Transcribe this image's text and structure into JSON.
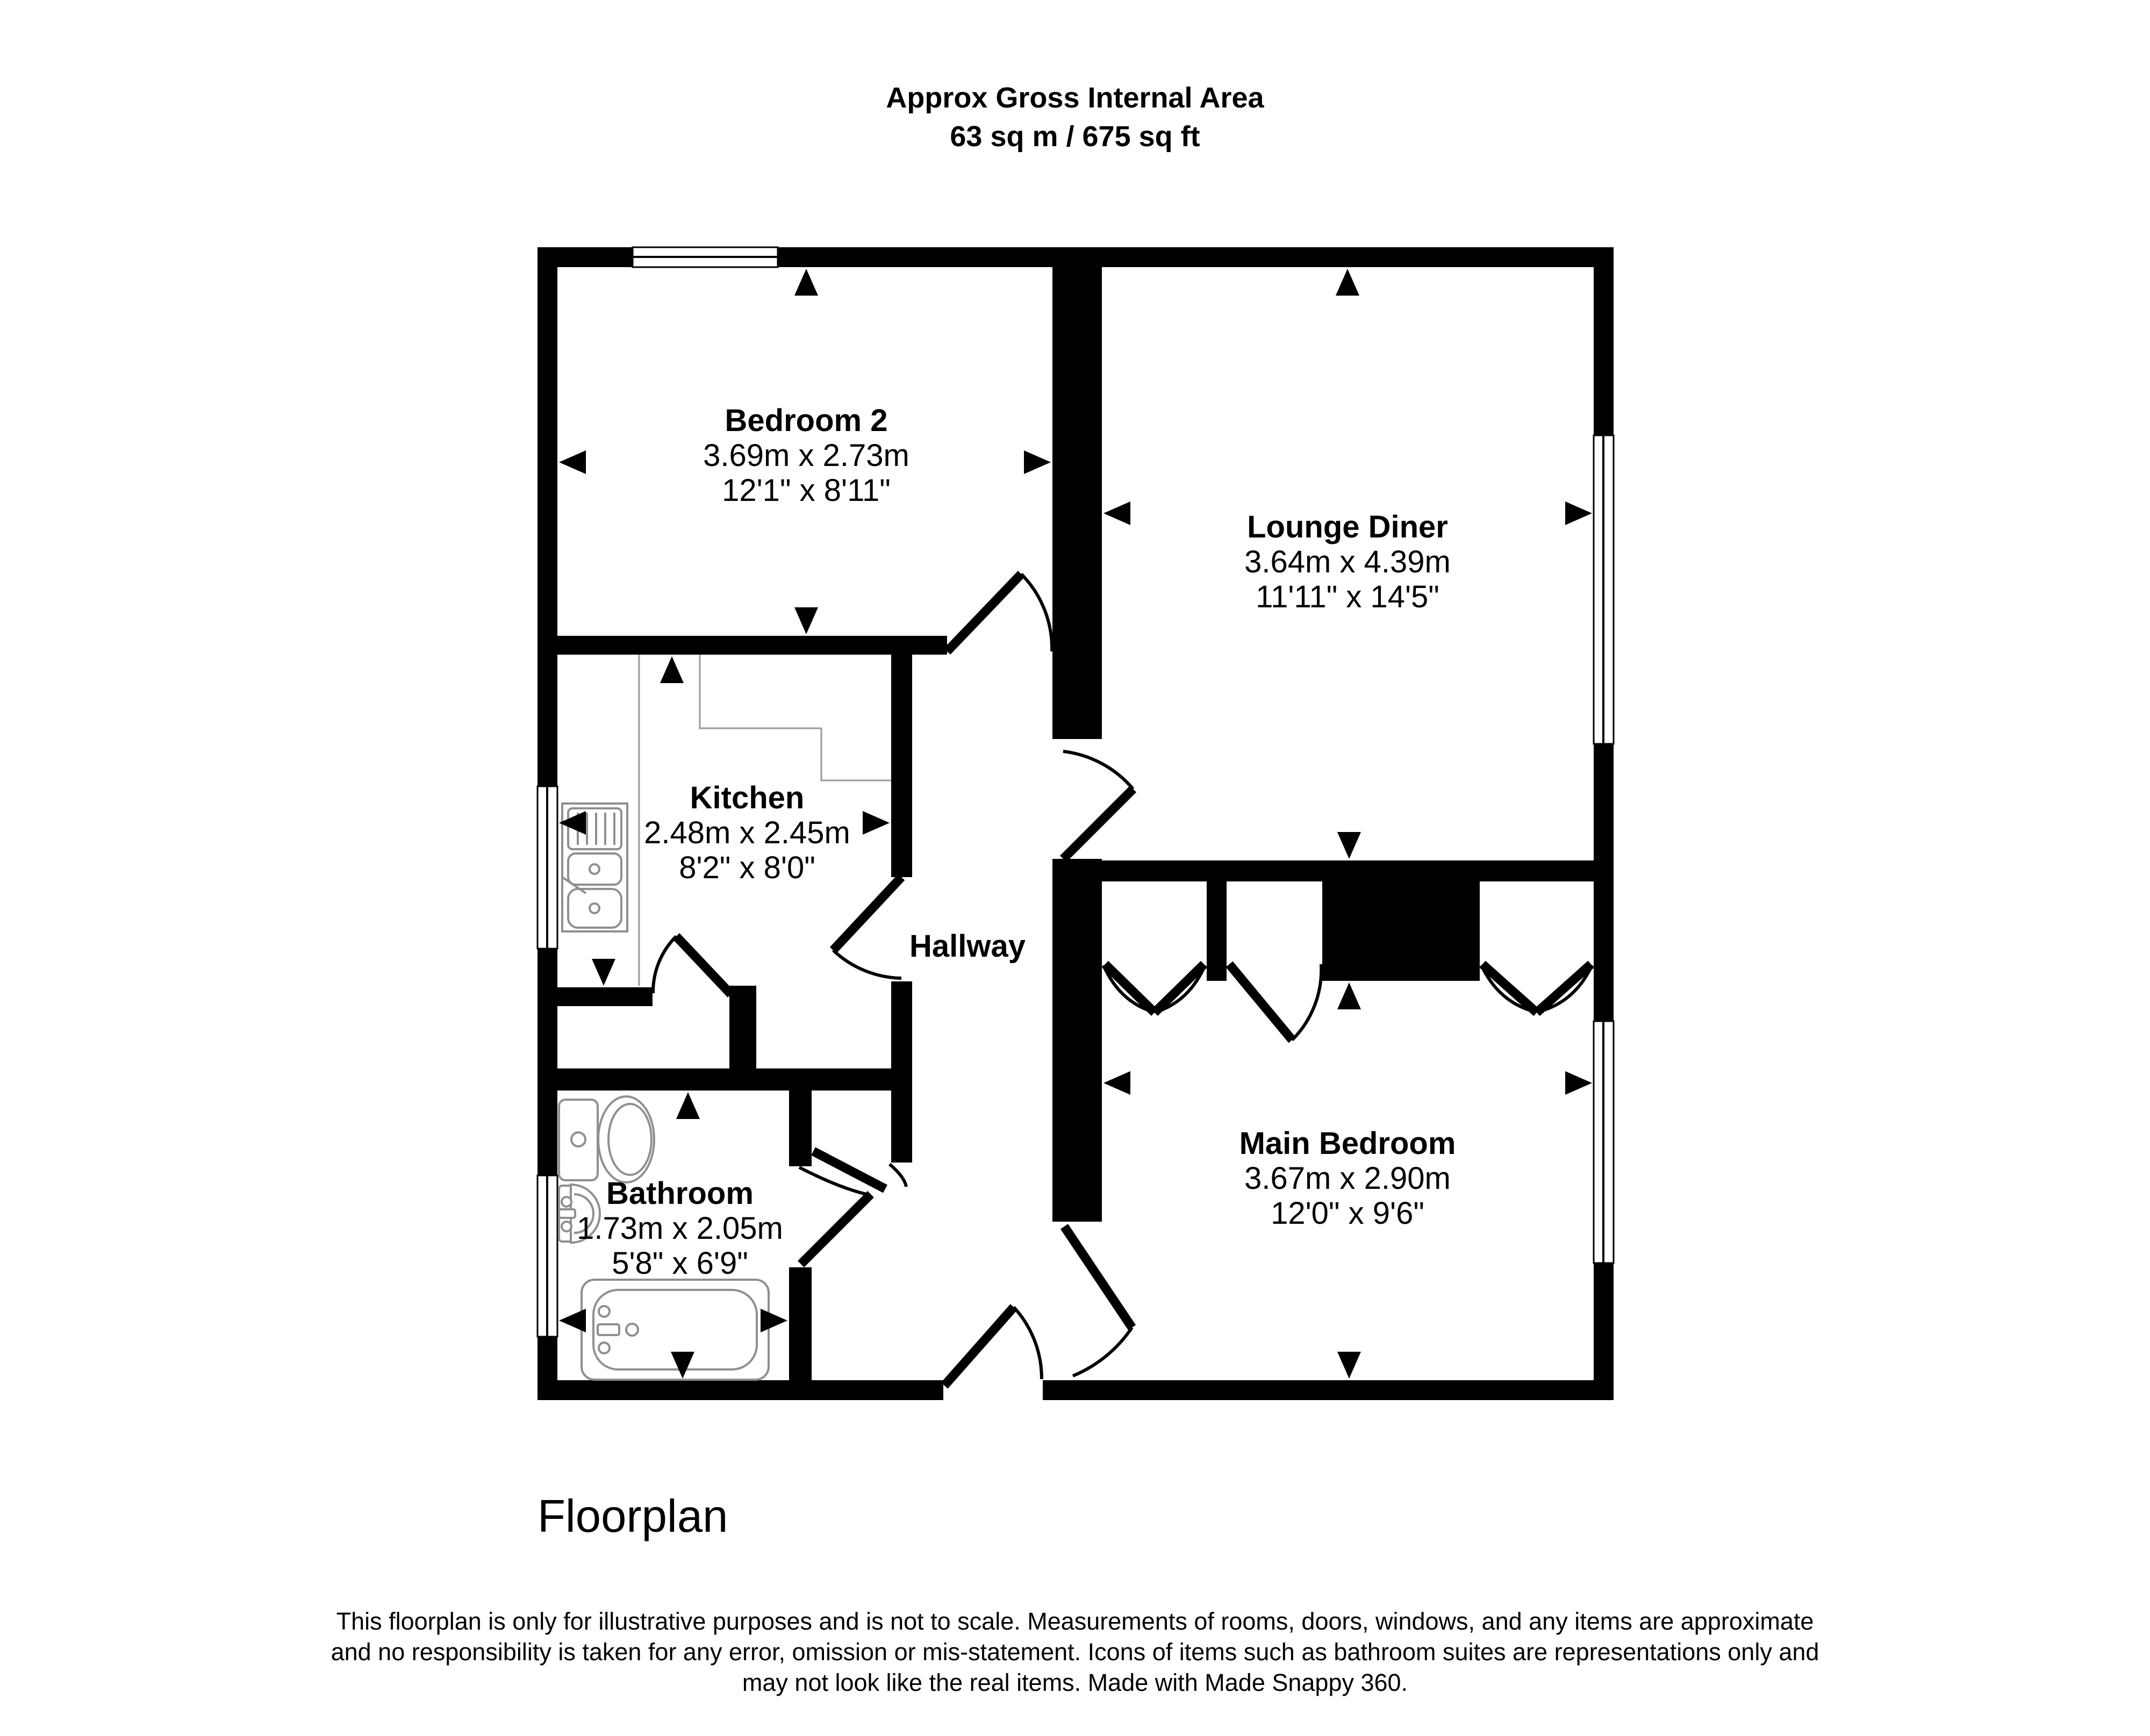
{
  "title": {
    "line1": "Approx Gross Internal Area",
    "line2": "63 sq m / 675 sq ft"
  },
  "rooms": [
    {
      "id": "bedroom-2",
      "name": "Bedroom 2",
      "metric": "3.69m x 2.73m",
      "imperial": "12'1\" x 8'11\""
    },
    {
      "id": "lounge-diner",
      "name": "Lounge Diner",
      "metric": "3.64m x 4.39m",
      "imperial": "11'11\" x 14'5\""
    },
    {
      "id": "kitchen",
      "name": "Kitchen",
      "metric": "2.48m x 2.45m",
      "imperial": "8'2\" x 8'0\""
    },
    {
      "id": "hallway",
      "name": "Hallway"
    },
    {
      "id": "bathroom",
      "name": "Bathroom",
      "metric": "1.73m x 2.05m",
      "imperial": "5'8\" x 6'9\""
    },
    {
      "id": "main-bedroom",
      "name": "Main Bedroom",
      "metric": "3.67m x 2.90m",
      "imperial": "12'0\" x 9'6\""
    }
  ],
  "caption": "Floorplan",
  "footer": {
    "line1": "This floorplan is only for illustrative purposes and is not to scale. Measurements of rooms, doors, windows, and any items are approximate",
    "line2": "and no responsibility is taken for any error, omission or mis-statement. Icons of items such as bathroom suites are representations only and",
    "line3": "may not look like the real items. Made with Made Snappy 360."
  },
  "colors": {
    "walls": "#000000",
    "background": "#ffffff",
    "fixtures": "#8f8f8f"
  }
}
